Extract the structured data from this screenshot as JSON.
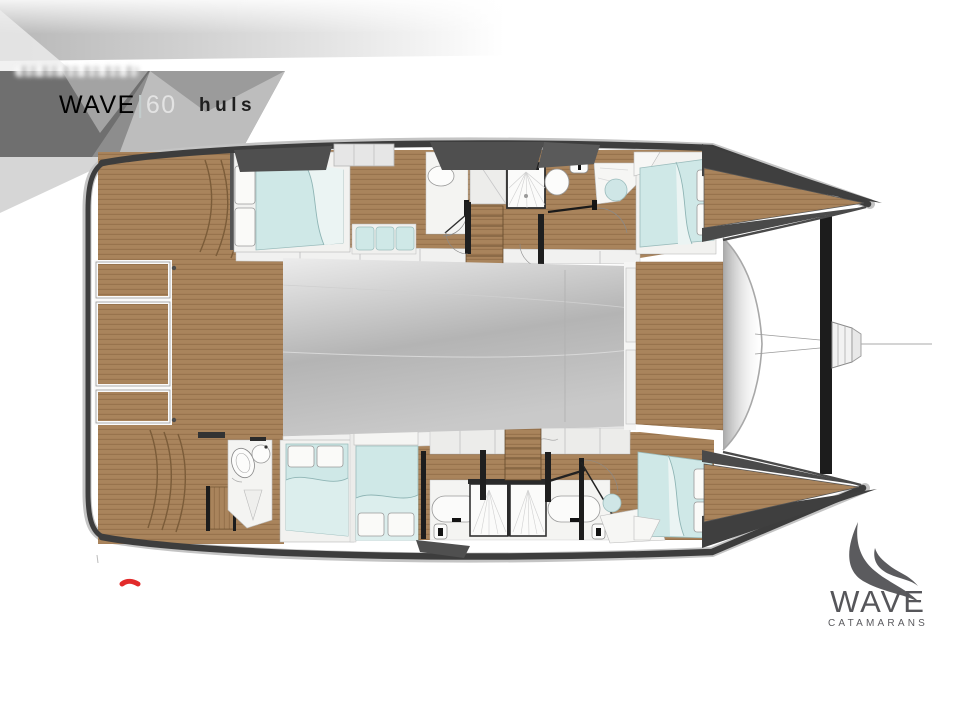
{
  "banner": {
    "model_name": "WAVE",
    "model_divider": "|",
    "model_size": "60",
    "brand_mark": "huls"
  },
  "logo": {
    "title": "WAVE",
    "subtitle": "CATAMARANS",
    "icon": "wave-swoosh-icon",
    "color": "#56565a"
  },
  "floorplan": {
    "type": "catamaran-deck-plan",
    "view": "top-down",
    "orientation": "bows-to-right",
    "hulls": [
      {
        "name": "port-hull",
        "rooms": [
          "aft-double-cabin",
          "settee",
          "aft-head-with-shower",
          "companionway-stairs",
          "mid-shower-room",
          "vanity-with-basin",
          "forward-double-cabin",
          "bow-foredeck"
        ]
      },
      {
        "name": "starboard-hull",
        "rooms": [
          "aft-head-with-wc",
          "aft-double-cabin",
          "mid-double-cabin",
          "twin-shower-rooms",
          "companionway-stairs",
          "vanity",
          "forward-double-cabin",
          "bow-foredeck"
        ]
      }
    ],
    "deck_features": [
      "aft-cockpit-teak-deck",
      "cockpit-locker-hatches",
      "cockpit-steps",
      "saloon-coachroof",
      "center-foredeck",
      "trampoline-area",
      "forward-crossbeam",
      "bowsprit",
      "forestay-line"
    ],
    "colors": {
      "deck_wood": "#a9845c",
      "deck_wood_line": "#8a6742",
      "upholstery_blue": "#cfe8e7",
      "pillow_white": "#fafaf8",
      "fixture_white": "#fbfbfa",
      "hull_outline_dark": "#3d3d3d",
      "saloon_gray": "#b7b7b7",
      "banner_dark_gray": "#6f6f6f",
      "banner_light_gray": "#bdbdbd"
    }
  },
  "annotations": {
    "red_mark_color": "#e22b2b"
  }
}
